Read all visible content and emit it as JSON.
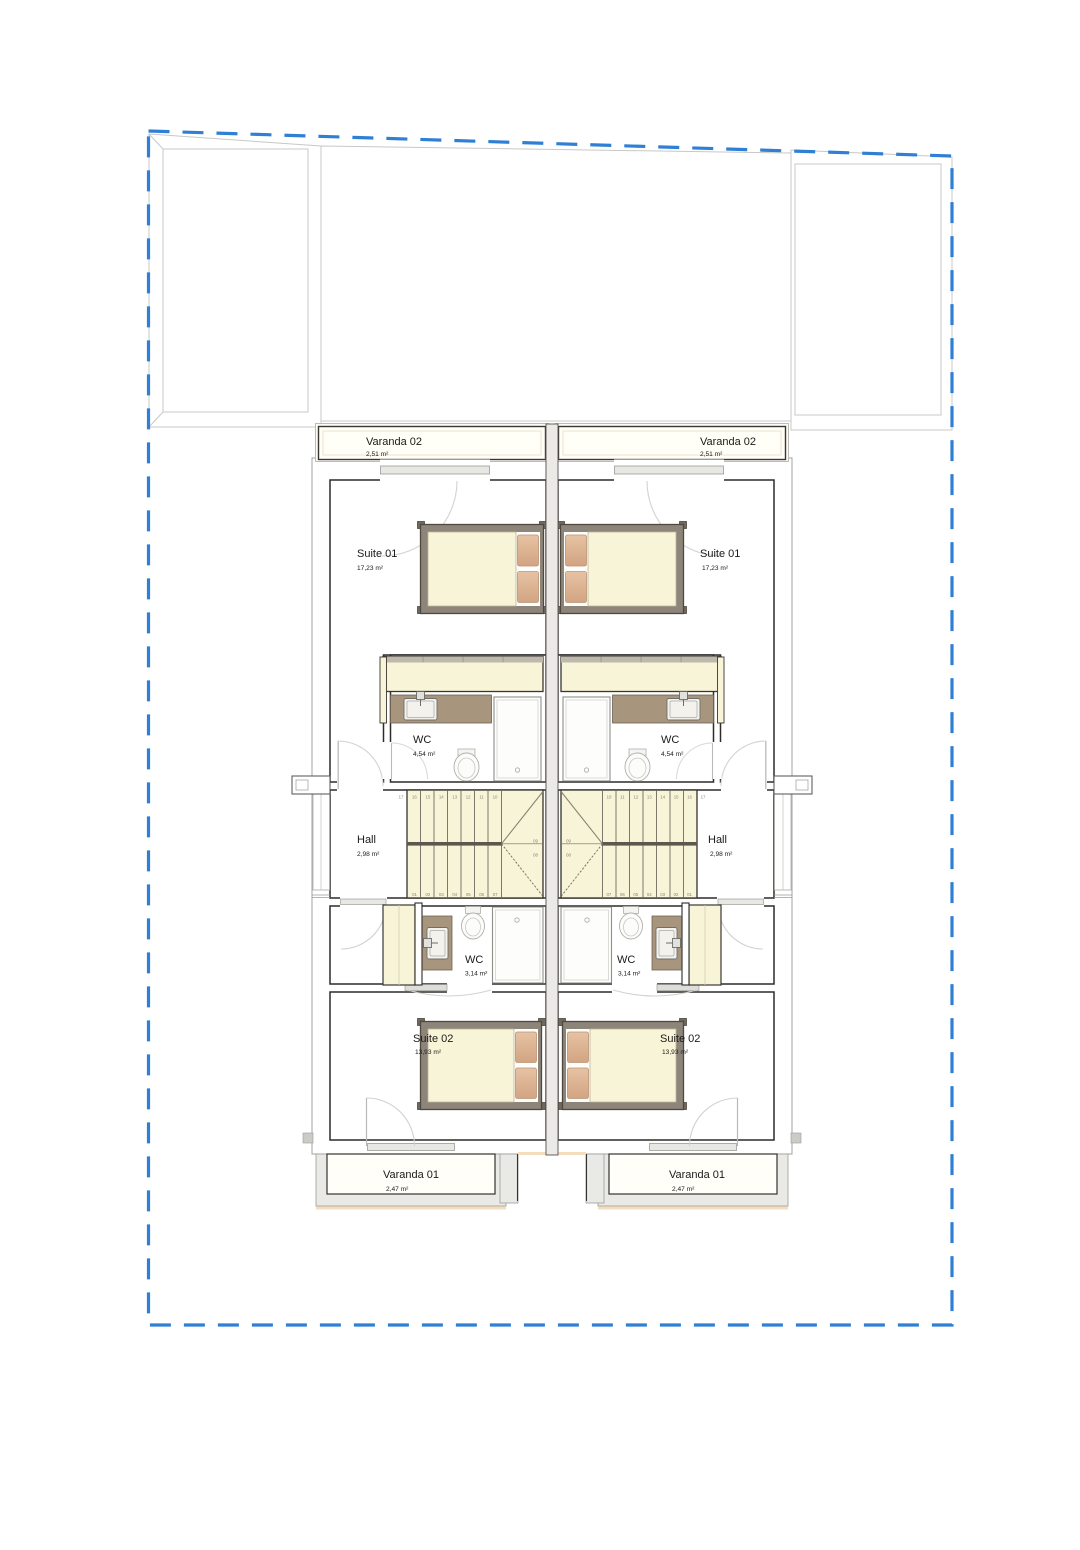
{
  "drawing": {
    "type": "floor-plan",
    "boundary_color": "#2f80d4",
    "colors": {
      "wall_dark": "#2e2b28",
      "wall_light": "#a3a39f",
      "floor_cream": "#f8f4d7",
      "pillow_tan": "#d9ae8e",
      "bed_frame": "#8d8579",
      "vanity_brown": "#a8957d",
      "balcony_floor": "#fffef8",
      "floor_edge_peach": "#f5ddbc"
    }
  },
  "units": {
    "left": {
      "varanda02": {
        "name": "Varanda 02",
        "area": "2,51 m²"
      },
      "suite01": {
        "name": "Suite 01",
        "area": "17,23 m²"
      },
      "wc1": {
        "name": "WC",
        "area": "4,54 m²"
      },
      "hall": {
        "name": "Hall",
        "area": "2,98 m²"
      },
      "wc2": {
        "name": "WC",
        "area": "3,14 m²"
      },
      "suite02": {
        "name": "Suite 02",
        "area": "13,93 m²"
      },
      "varanda01": {
        "name": "Varanda 01",
        "area": "2,47 m²"
      }
    },
    "right": {
      "varanda02": {
        "name": "Varanda 02",
        "area": "2,51 m²"
      },
      "suite01": {
        "name": "Suite 01",
        "area": "17,23 m²"
      },
      "wc1": {
        "name": "WC",
        "area": "4,54 m²"
      },
      "hall": {
        "name": "Hall",
        "area": "2,98 m²"
      },
      "wc2": {
        "name": "WC",
        "area": "3,14 m²"
      },
      "suite02": {
        "name": "Suite 02",
        "area": "13,93 m²"
      },
      "varanda01": {
        "name": "Varanda 01",
        "area": "2,47 m²"
      }
    }
  },
  "stairs": {
    "top_run": [
      "17",
      "16",
      "15",
      "14",
      "13",
      "12",
      "11",
      "10"
    ],
    "bottom_run": [
      "01",
      "02",
      "03",
      "04",
      "05",
      "06",
      "07"
    ],
    "winders": [
      "09",
      "08"
    ]
  }
}
